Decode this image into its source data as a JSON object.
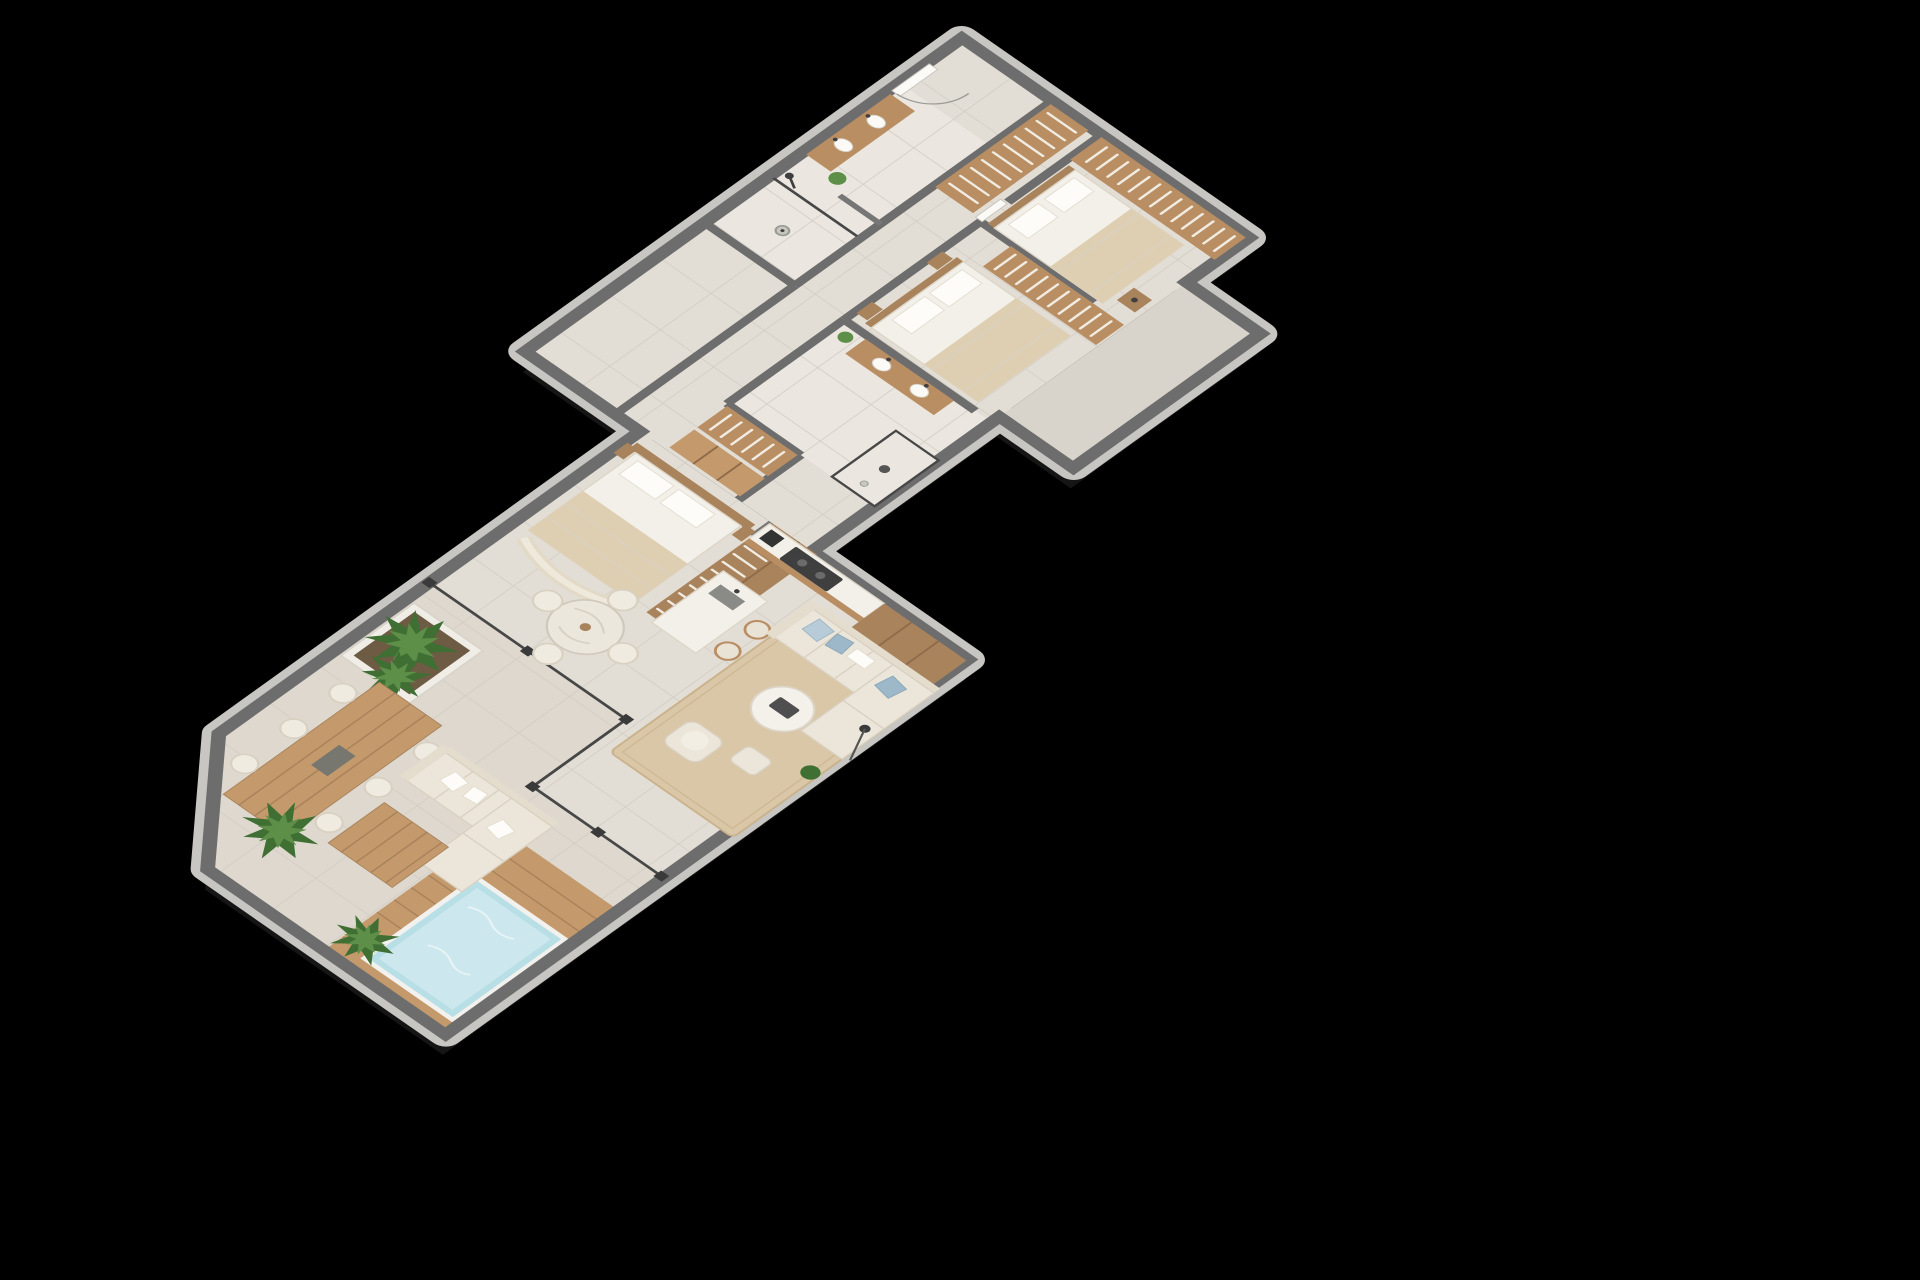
{
  "meta": {
    "content_type": "3d-isometric-floor-plan-render",
    "background_color": "#000000",
    "view": "isometric cutaway (roof removed, wall tops visible)",
    "visible_text": "none"
  },
  "palette": {
    "background": "#000000",
    "wall_top": "#6d6d6d",
    "wall_face": "#c7c6c2",
    "floor_tile": "#e3ded5",
    "bathroom_floor": "#ebe7e0",
    "wood_cabinet": "#b98e63",
    "wood_dark": "#a9835c",
    "deck_wood": "#c49a6c",
    "upholstery_cream": "#ece6da",
    "bedding_white": "#f3f0ea",
    "throw_tan": "#decfb2",
    "pillow_blue": "#9db8c8",
    "plant_green": "#3f6f33",
    "pool_water": "#b9dfe6",
    "rug_jute": "#d9c7a7",
    "glass_line": "#474747"
  },
  "apartment": {
    "wings": [
      {
        "id": "upper-wing",
        "rooms": [
          "bedroom-3",
          "bedroom-2",
          "bathroom-2",
          "shower-room-2",
          "entry-hall",
          "hall-closet",
          "master-bathroom",
          "walk-in-closet",
          "storage",
          "balcony"
        ]
      },
      {
        "id": "lower-wing",
        "rooms": [
          "master-bedroom",
          "master-wardrobe",
          "kitchen",
          "breakfast-area",
          "living-area",
          "terrace-dining",
          "terrace-lounge",
          "pool-deck"
        ]
      }
    ],
    "rooms": [
      {
        "id": "bedroom-3",
        "furniture": [
          "wardrobe-with-hanging-clothes",
          "double-bed",
          "pillows",
          "tan-throw",
          "nightstand"
        ]
      },
      {
        "id": "bedroom-2",
        "furniture": [
          "wardrobe-with-hanging-clothes",
          "double-bed",
          "pillows",
          "tan-throw",
          "nightstand",
          "nightstand"
        ]
      },
      {
        "id": "bathroom-2",
        "furniture": [
          "double-vanity",
          "two-basins",
          "plant"
        ]
      },
      {
        "id": "shower-room-2",
        "furniture": [
          "walk-in-shower",
          "floor-drain",
          "glass-screen"
        ]
      },
      {
        "id": "entry-hall",
        "furniture": [
          "entry-door",
          "corridor-door"
        ]
      },
      {
        "id": "hall-closet",
        "furniture": [
          "wardrobe-with-hanging-clothes"
        ]
      },
      {
        "id": "master-bathroom",
        "furniture": [
          "vanity",
          "two-basins",
          "walk-in-shower",
          "rain-shower-head",
          "plant"
        ]
      },
      {
        "id": "walk-in-closet",
        "furniture": [
          "wardrobe-with-hanging-clothes",
          "shelf-unit"
        ]
      },
      {
        "id": "balcony",
        "furniture": []
      },
      {
        "id": "master-bedroom",
        "furniture": [
          "double-bed",
          "headboard-panel",
          "pillows",
          "tan-throw",
          "curved-bench",
          "nightstand",
          "nightstand"
        ]
      },
      {
        "id": "master-wardrobe",
        "furniture": [
          "wardrobe-with-hanging-clothes"
        ]
      },
      {
        "id": "kitchen",
        "furniture": [
          "counter-with-cooktop",
          "coffee-machine",
          "island-with-sink",
          "bar-stool",
          "bar-stool",
          "tall-pantry",
          "plant"
        ]
      },
      {
        "id": "breakfast-area",
        "furniture": [
          "round-marble-table",
          "chair",
          "chair",
          "chair",
          "chair"
        ]
      },
      {
        "id": "living-area",
        "furniture": [
          "jute-rug",
          "l-shaped-sofa",
          "blue-pillows",
          "round-coffee-table",
          "tray",
          "armchair",
          "footstool",
          "floor-lamp",
          "plant"
        ]
      },
      {
        "id": "terrace-dining",
        "furniture": [
          "planter-box",
          "large-plants",
          "wood-dining-table",
          "centerpiece",
          "chair",
          "chair",
          "chair",
          "chair",
          "chair",
          "chair"
        ]
      },
      {
        "id": "terrace-lounge",
        "furniture": [
          "outdoor-l-sofa",
          "pillows",
          "wood-deck-table",
          "palm-plant"
        ]
      },
      {
        "id": "pool-deck",
        "furniture": [
          "wood-deck",
          "plunge-pool",
          "palm-plant"
        ]
      }
    ]
  }
}
